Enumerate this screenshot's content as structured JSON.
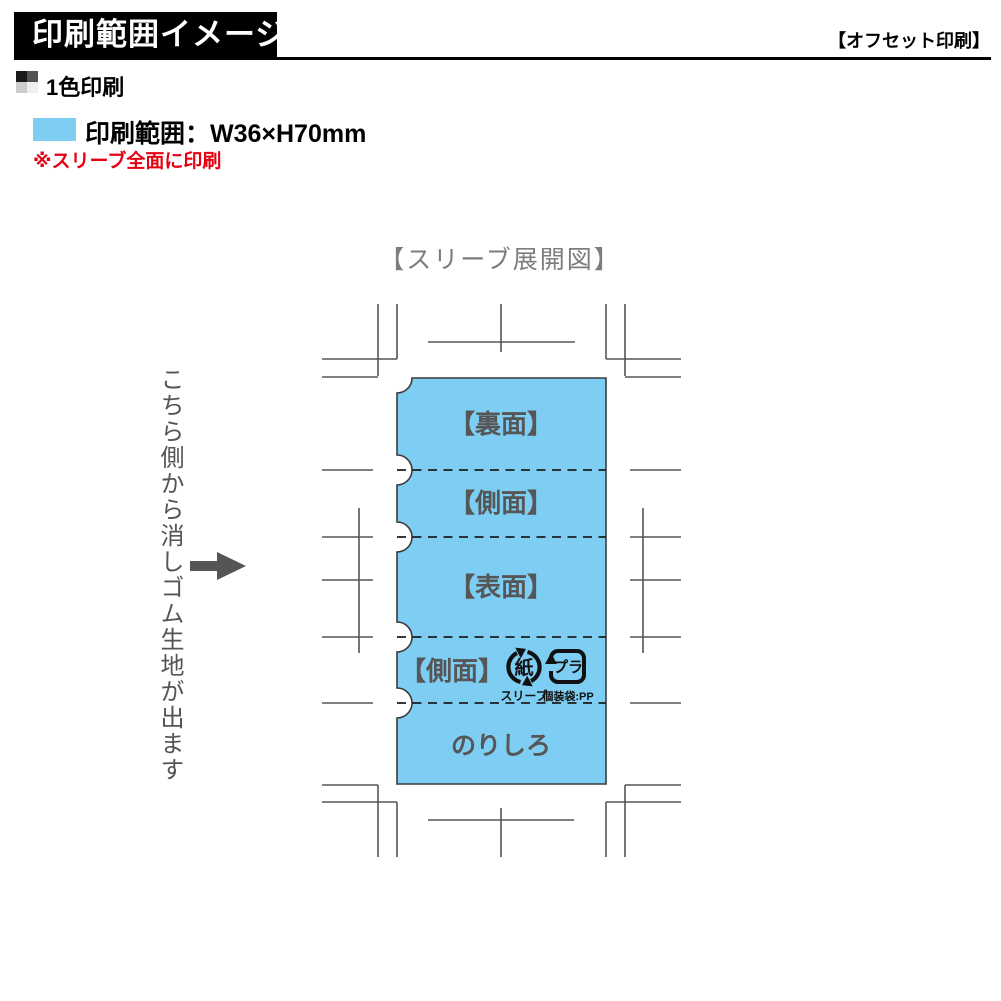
{
  "header": {
    "banner_title": "印刷範囲イメージ",
    "print_method": "【オフセット印刷】"
  },
  "legend": {
    "color_mode": "1色印刷",
    "print_area_label": "印刷範囲：W36×H70mm",
    "note": "※スリーブ全面に印刷",
    "print_area_color": "#7ECEF4",
    "note_color": "#e60012",
    "checker_colors": [
      "#1a1a1a",
      "#545454",
      "#cccccc",
      "#efefef"
    ]
  },
  "diagram": {
    "title": "【スリーブ展開図】",
    "side_note": "こちら側から消しゴム生地が出ます",
    "panels": [
      {
        "label": "【裏面】"
      },
      {
        "label": "【側面】"
      },
      {
        "label": "【表面】"
      },
      {
        "label": "【側面】"
      },
      {
        "label": "のりしろ"
      }
    ],
    "recycle_marks": {
      "paper_symbol": "紙",
      "paper_caption": "スリーブ",
      "plastic_symbol": "プラ",
      "plastic_caption": "個装袋:PP"
    },
    "colors": {
      "sleeve_fill": "#7ECEF4",
      "mark_line": "#555555"
    }
  }
}
